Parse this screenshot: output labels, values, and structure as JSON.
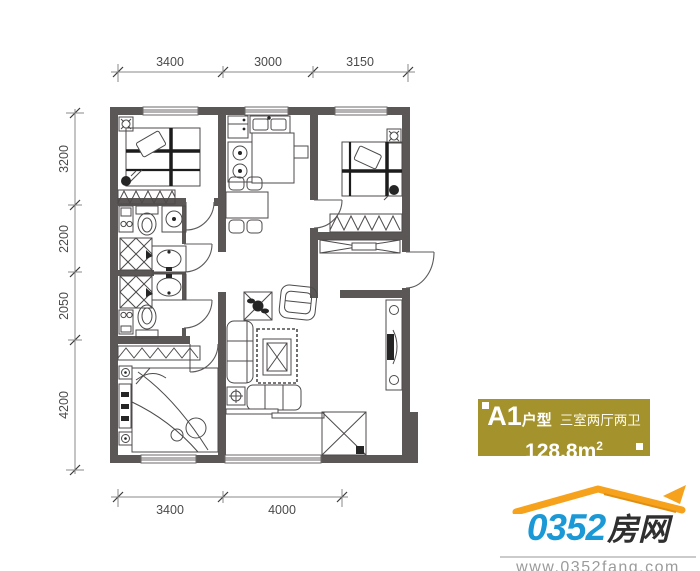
{
  "floorplan": {
    "dimensions_top": [
      "3400",
      "3000",
      "3150"
    ],
    "dimensions_left": [
      "3200",
      "2200",
      "2050",
      "4200"
    ],
    "dimensions_bottom": [
      "3400",
      "4000"
    ]
  },
  "badge": {
    "unit": "A1",
    "unit_suffix": "户型",
    "rooms": "三室两厅两卫",
    "area": "128.8m",
    "area_sup": "2",
    "bg_color": "#a4922c"
  },
  "logo": {
    "number": "0352",
    "name": "房网",
    "url": "www.0352fang.com",
    "colors": {
      "blue": "#1b98d6",
      "orange": "#f6a21c",
      "dark": "#2f2f2f"
    }
  }
}
